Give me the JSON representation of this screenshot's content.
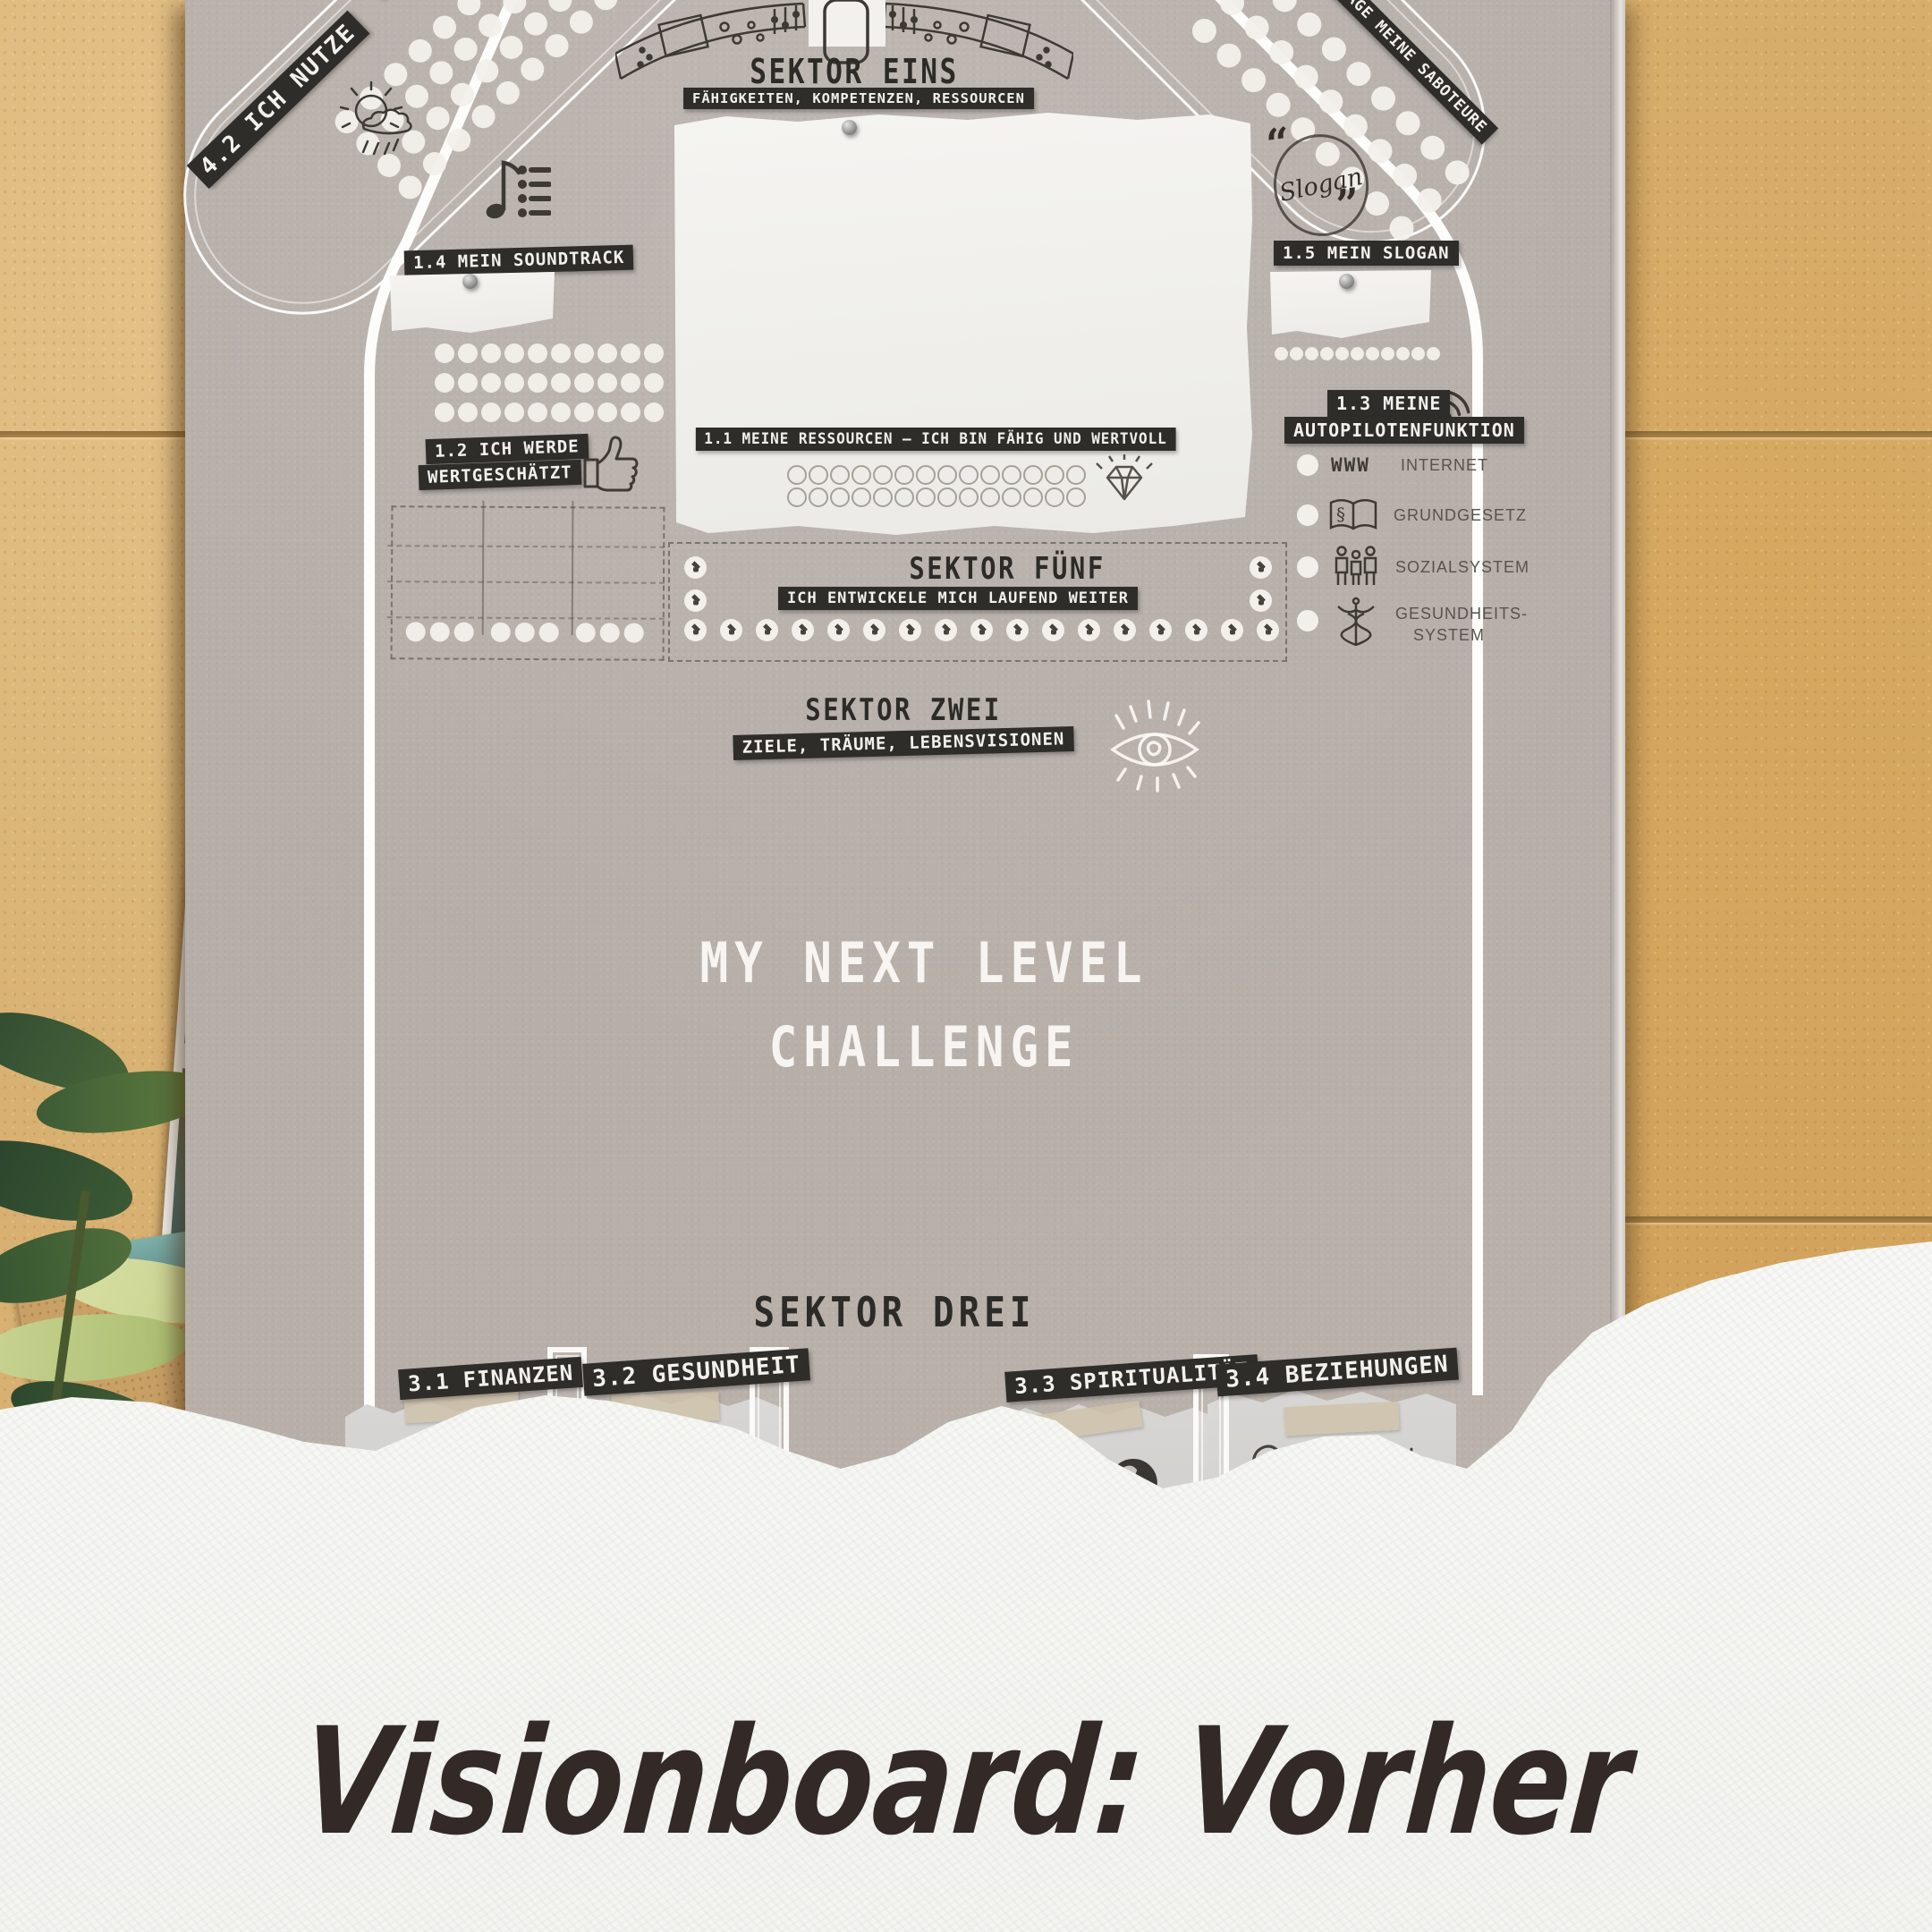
{
  "caption": {
    "text": "Visionboard: Vorher"
  },
  "poster": {
    "sektor1": {
      "title": "SEKTOR EINS",
      "subtitle": "FÄHIGKEITEN, KOMPETENZEN, RESSOURCEN"
    },
    "sektor2": {
      "title": "SEKTOR ZWEI",
      "subtitle": "ZIELE, TRÄUME, LEBENSVISIONEN"
    },
    "sektor3": {
      "title": "SEKTOR DREI",
      "labels": [
        "3.1 FINANZEN",
        "3.2 GESUNDHEIT",
        "3.3 SPIRITUALITÄT",
        "3.4 BEZIEHUNGEN"
      ]
    },
    "sektor5": {
      "title": "SEKTOR FÜNF",
      "subtitle": "ICH ENTWICKELE MICH LAUFEND WEITER"
    },
    "resources_label": "1.1 MEINE RESSOURCEN – ICH BIN FÄHIG UND WERTVOLL",
    "valued_label_line1": "1.2 ICH WERDE",
    "valued_label_line2": "WERTGESCHÄTZT",
    "soundtrack_label": "1.4 MEIN SOUNDTRACK",
    "slogan_label": "1.5 MEIN SLOGAN",
    "slogan_stamp": {
      "text": "Slogan",
      "quote_open": "“",
      "quote_close": "”"
    },
    "saboteure_label": "MANAGE MEINE SABOTEURE",
    "nutze_label_line1": "4.2 ICH NUTZE",
    "nutze_label_line2": "ZUR WE",
    "center_title_line1": "MY NEXT LEVEL",
    "center_title_line2": "CHALLENGE",
    "autopilot": {
      "label_line1": "1.3 MEINE",
      "label_line2": "AUTOPILOTENFUNKTION",
      "paragraph_glyph": "§",
      "www_text": "WWW",
      "items": [
        {
          "icon": "www-icon",
          "label": "INTERNET"
        },
        {
          "icon": "law-book-icon",
          "label": "GRUNDGESETZ"
        },
        {
          "icon": "people-icon",
          "label": "SOZIALSYSTEM"
        },
        {
          "icon": "caduceus-icon",
          "label": "GESUNDHEITS-",
          "label2": "SYSTEM"
        }
      ]
    }
  },
  "decor": {
    "tl_dots": {
      "rows": 4,
      "cols": 9,
      "d": 26,
      "sx": 38,
      "sy": 34,
      "kind": "fill"
    },
    "tr_dots": {
      "rows": 3,
      "cols": 9,
      "d": 27,
      "sx": 39,
      "sy": 44,
      "kind": "fill"
    },
    "soundtrack_dots": {
      "rows": 3,
      "cols": 10,
      "d": 22,
      "sx": 26,
      "sy": 33,
      "kind": "fill"
    },
    "table_dots": {
      "rows": 1,
      "cols": 9,
      "d": 22,
      "sx": 27,
      "sy": 0,
      "kind": "fill",
      "groupSize": 3,
      "groupGap": 14
    },
    "resource_rings": {
      "rows": 2,
      "cols": 14,
      "d": 22,
      "sx": 24,
      "sy": 25,
      "kind": "ring"
    },
    "s5_left": {
      "rows": 2,
      "cols": 1,
      "d": 25,
      "sx": 0,
      "sy": 37,
      "kind": "cap"
    },
    "s5_right": {
      "rows": 2,
      "cols": 1,
      "d": 25,
      "sx": 0,
      "sy": 37,
      "kind": "cap"
    },
    "s5_bottom": {
      "rows": 1,
      "cols": 17,
      "d": 25,
      "sx": 40,
      "sy": 0,
      "kind": "cap"
    },
    "slogan_dots": {
      "rows": 1,
      "cols": 11,
      "d": 15,
      "sx": 17,
      "sy": 0,
      "kind": "fill"
    }
  }
}
